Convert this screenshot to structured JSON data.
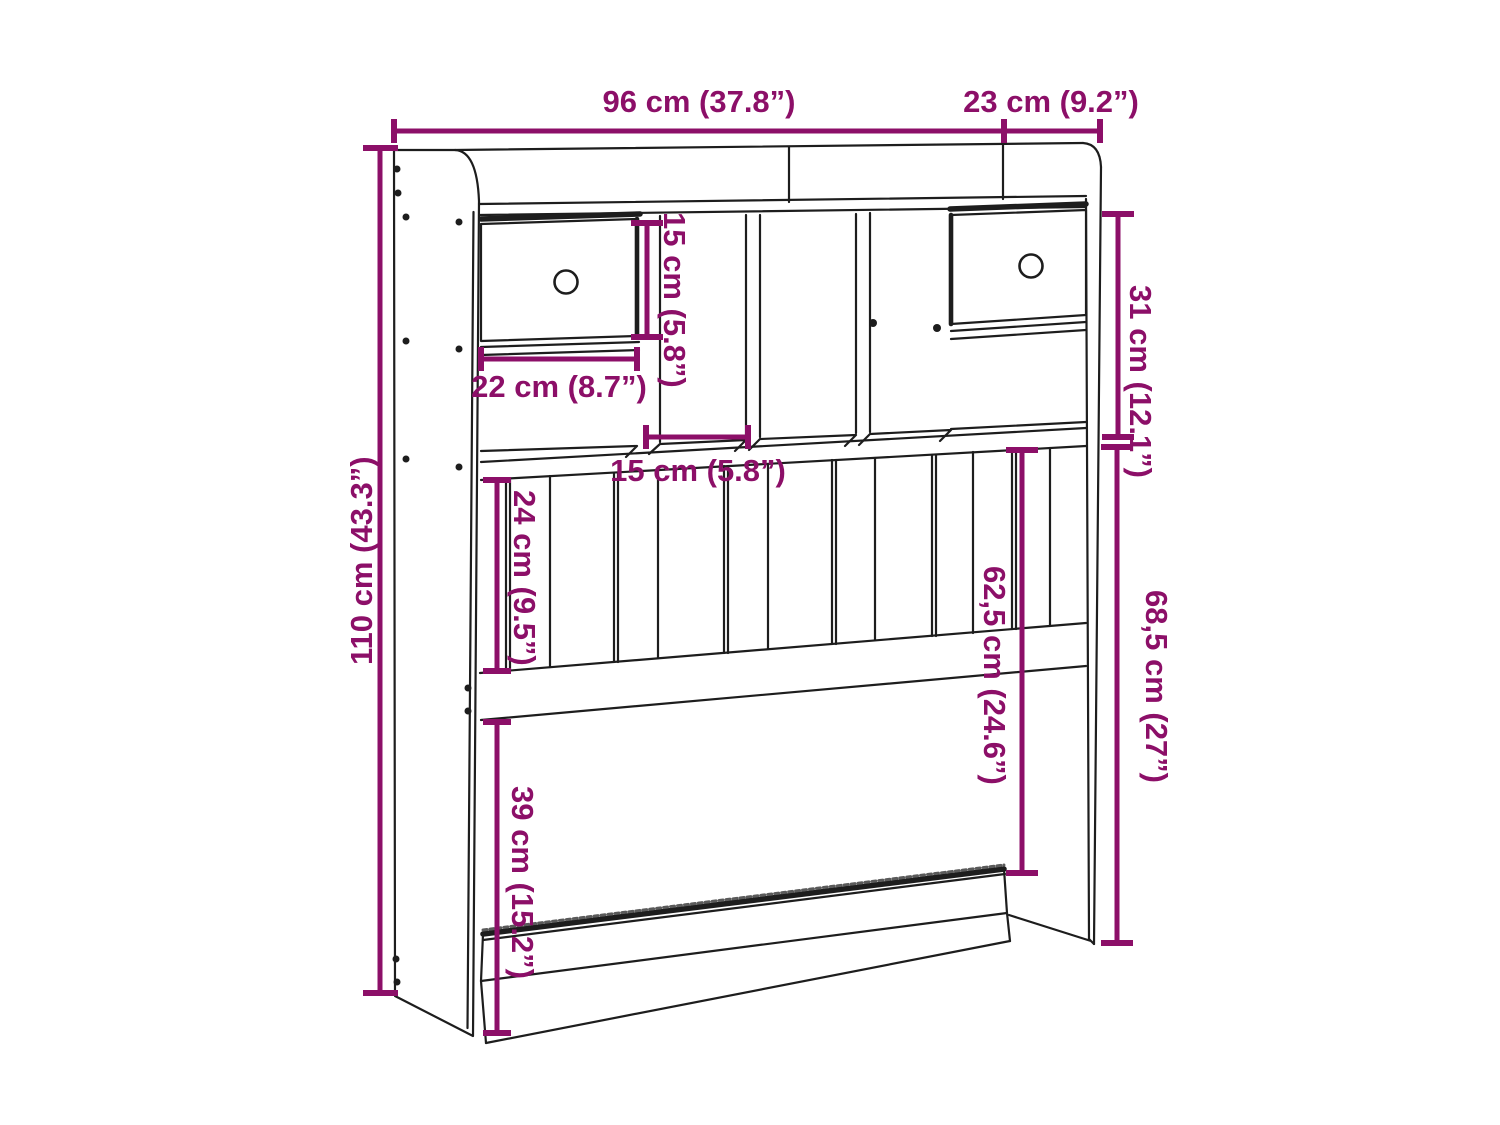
{
  "figure": {
    "type": "furniture dimension diagram",
    "subject": "headboard with storage compartments, drawers and slat panel",
    "accent_color": "#8c0f68",
    "line_color": "#1d1d1d",
    "background_color": "#ffffff"
  },
  "dimensions": {
    "total_width": "96 cm (37.8”)",
    "total_depth": "23 cm (9.2”)",
    "total_height": "110 cm (43.3”)",
    "compartment_height": "15 cm (5.8”)",
    "drawer_width": "22 cm (8.7”)",
    "compartment_width": "15 cm (5.8”)",
    "slat_panel_height": "24 cm (9.5”)",
    "upper_section_height": "31 cm (12.1”)",
    "shelf_to_rail_height": "62,5 cm (24.6”)",
    "lower_section_height": "68,5 cm (27”)",
    "lower_clearance_height": "39 cm (15.2”)"
  }
}
